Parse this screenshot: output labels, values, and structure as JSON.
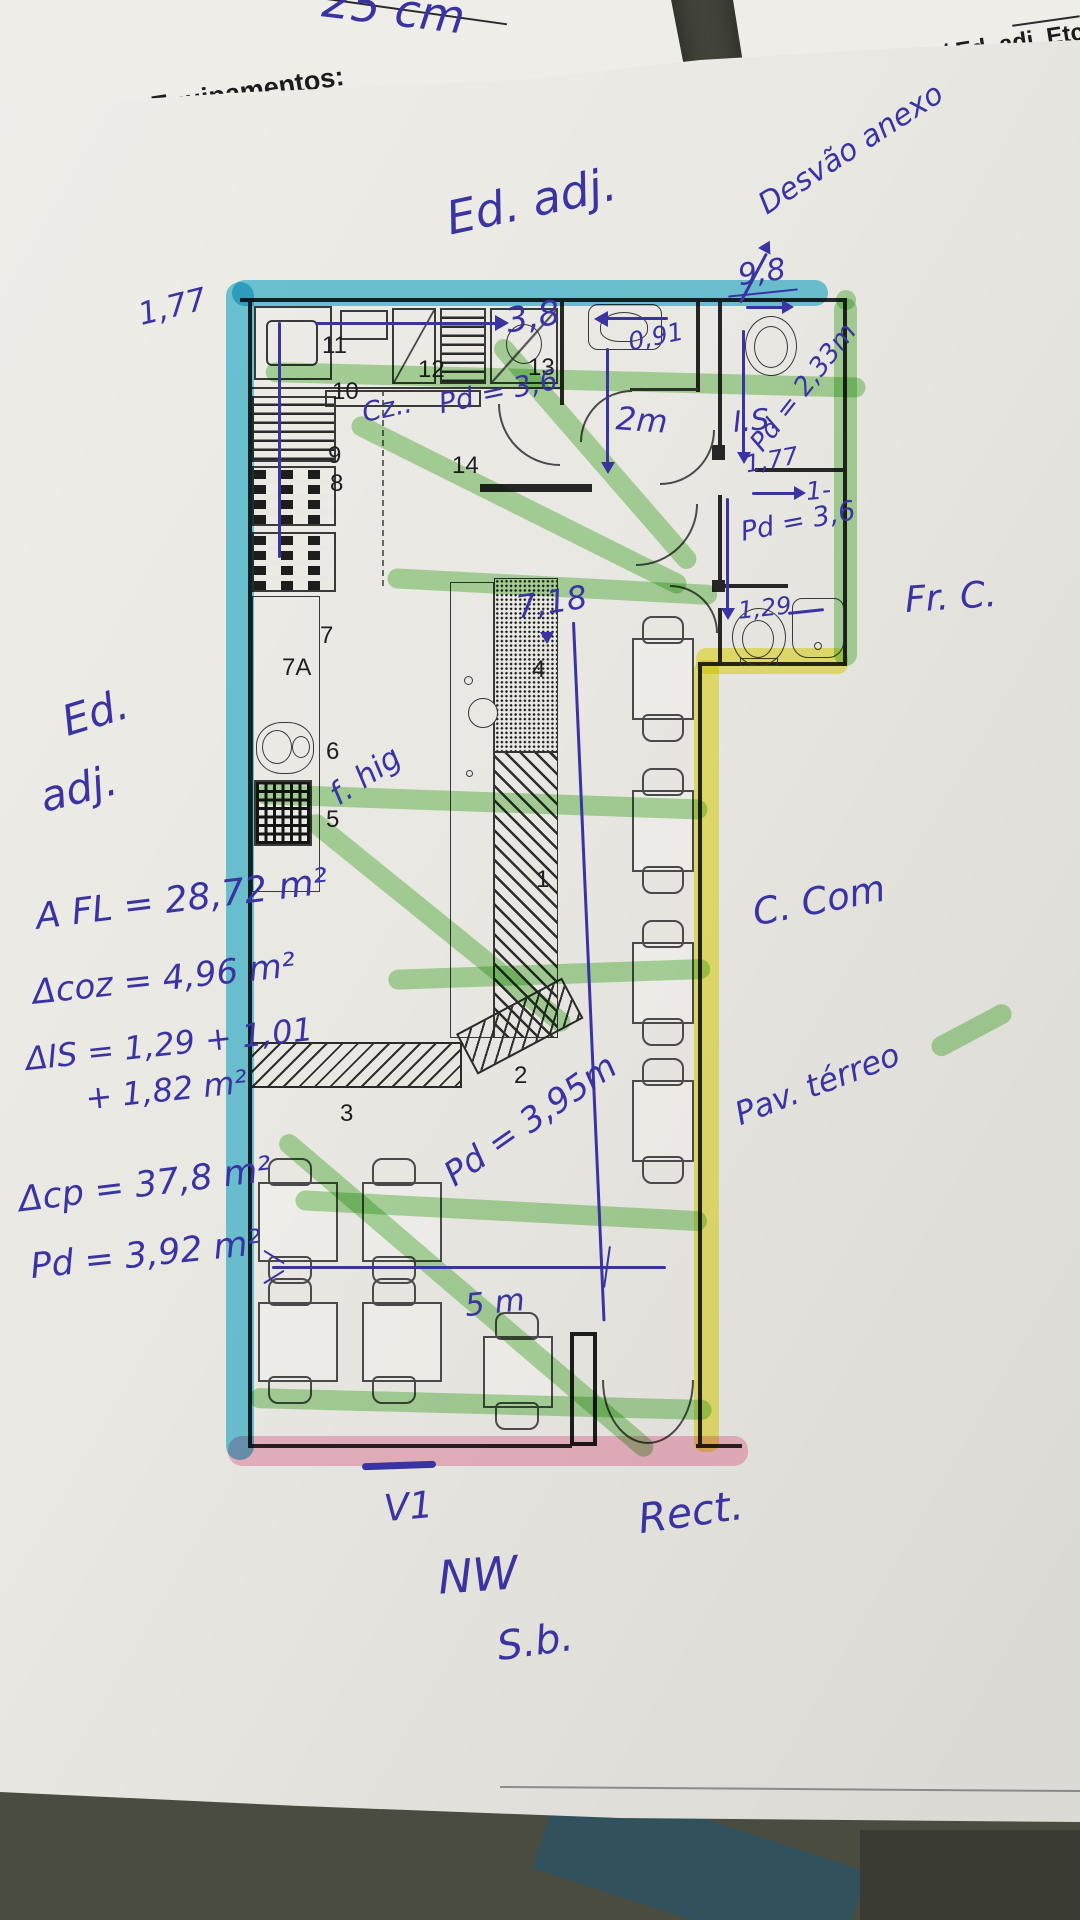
{
  "colors": {
    "pen": "#3a33a2",
    "cyan": "#2fb9dc",
    "green": "#6fc45a",
    "yellow": "#f0ea3e",
    "pink": "#f7a8c4",
    "paper": "#ebe9e3",
    "background": "#42443a"
  },
  "top_left_sheet": {
    "dim_note": "25 cm",
    "heading": "Equipamentos:",
    "item1": "Elevador",
    "item1_mark": "✓",
    "item2": "Rede de Gá"
  },
  "top_right_sheet": {
    "heading": "nteriores CC / Ed. adj. Etc.:",
    "field_label": "ra:",
    "field_value": "15cm"
  },
  "plan": {
    "room_numbers": {
      "n1": "1",
      "n2": "2",
      "n3": "3",
      "n4": "4",
      "n5": "5",
      "n6": "6",
      "n7": "7",
      "n7a": "7A",
      "n8": "8",
      "n9": "9",
      "n10": "10",
      "n11": "11",
      "n12": "12",
      "n13": "13",
      "n14": "14"
    },
    "annotations": {
      "ed_adj_top": "Ed. adj.",
      "desvao_anexo": "Desvão anexo",
      "dim_9_8": "9,8",
      "dim_3_8": "3,8",
      "dim_0_91": "0,91",
      "dim_1_77_left": "1,77",
      "cz": "Cz..",
      "pd_3_6_kitchen": "Pd = 3,6",
      "dim_2m": "2m",
      "pd_2_33": "Pd = 2,33m",
      "is_label": "I.S.",
      "dim_1_77_is": "1,77",
      "one_dash": "1-",
      "pd_3_6_wc": "Pd = 3,6",
      "dim_1_29": "1,29",
      "dim_7_18": "7,18",
      "f_hig": "f. hig",
      "ed_adj_left_1": "Ed.",
      "ed_adj_left_2": "adj.",
      "fr_c": "Fr. C.",
      "c_com": "C. Com",
      "pav_terreo": "Pav. térreo",
      "pd_3_95": "Pd = 3,95m",
      "dim_5m": "5 m",
      "v1": "V1",
      "rect": "Rect.",
      "nw": "NW",
      "sb": "S.b."
    },
    "formulas": {
      "f1": "A FL = 28,72 m²",
      "f2": "Δcoz = 4,96 m²",
      "f3a": "ΔIS = 1,29 + 1,01",
      "f3b": "+ 1,82 m²",
      "f4": "Δcp = 37,8 m²",
      "f5": "Pd = 3,92 m²"
    }
  }
}
